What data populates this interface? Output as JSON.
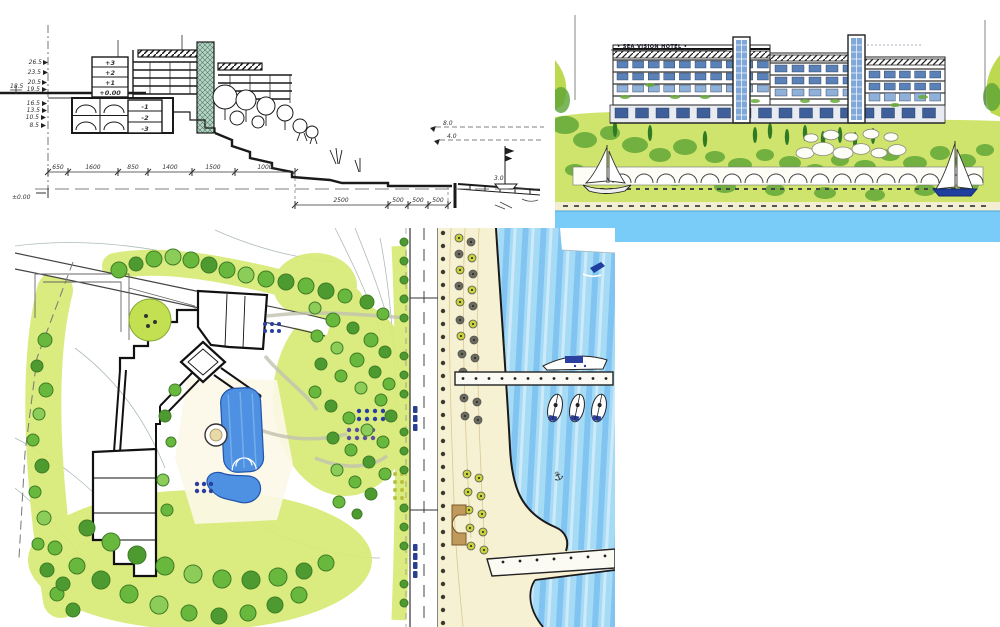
{
  "page": {
    "background": "#ffffff",
    "description": "Architectural presentation collage for a coastal hotel: hand-drawn site section, colored seafront elevation rendering, and colored landscape site plan"
  },
  "section_sketch": {
    "floor_labels": [
      "+3",
      "+2",
      "+1",
      "+0.00",
      "-1",
      "-2",
      "-3"
    ],
    "left_elevation_marks": [
      "26.5",
      "23.5",
      "20.5",
      "19.5"
    ],
    "left_lower_marks": [
      "16.5",
      "13.5",
      "10.5",
      "8.5"
    ],
    "road_level_mark": "18.5",
    "datum_label": "±0.00",
    "upper_dimensions": [
      "650",
      "1600",
      "850",
      "1400",
      "1500",
      "1000"
    ],
    "lower_dimensions": [
      "2500",
      "500",
      "500",
      "500"
    ],
    "slope_marks": [
      "8.0",
      "4.0"
    ],
    "shore_mark": "3.0"
  },
  "hotel_rendering": {
    "sign_text": "• SEA VISION HOTEL •",
    "colors": {
      "water": "#79CCF7",
      "window_blue": "#5B82B8",
      "glass_tower": "#7FA8D8",
      "hill_light": "#CFE46D",
      "hill_dark": "#5AA233"
    }
  },
  "site_plan": {
    "anchor_symbol": "⚓",
    "colors": {
      "lawn": "#D9EA79",
      "tree_green": "#69B83E",
      "pool_blue": "#4E90E2",
      "water_base": "#A5DBF5",
      "water_streak": "#6FB9EE",
      "sand": "#F7F1D4"
    }
  }
}
